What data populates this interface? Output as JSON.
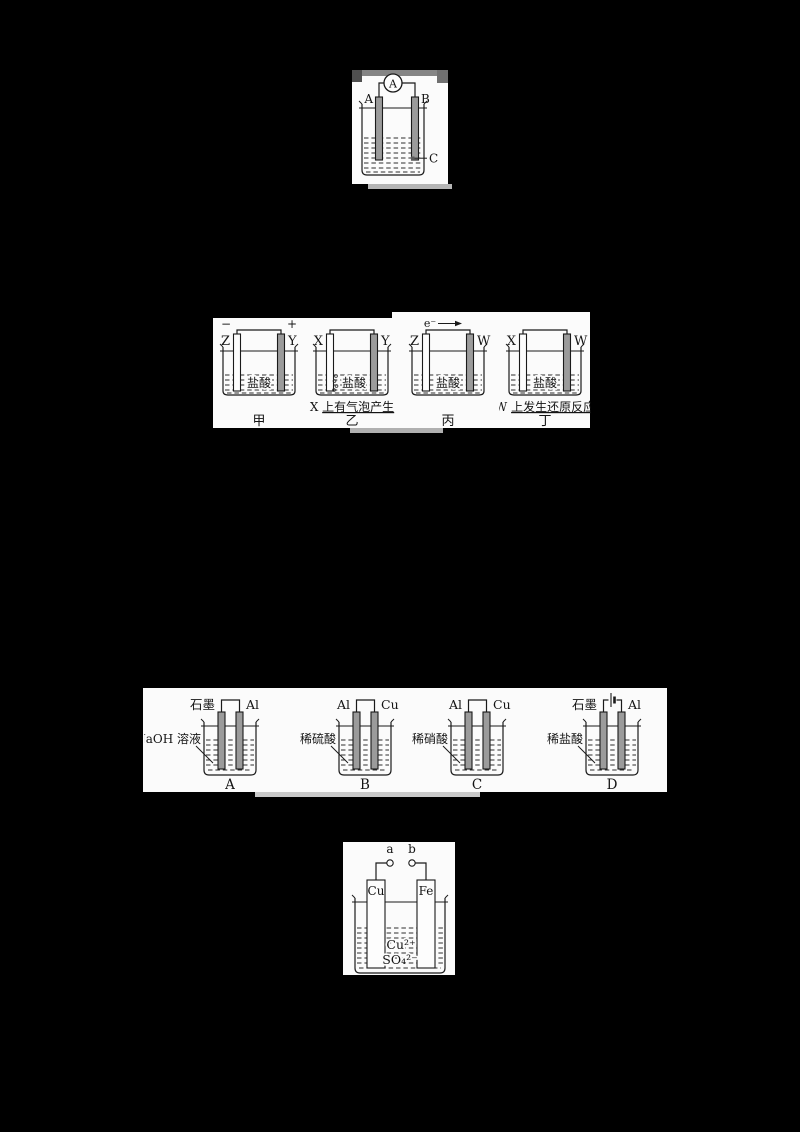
{
  "colors": {
    "background": "#000000",
    "panel": "#fbfbfb",
    "ink": "#1a1a1a",
    "electrode_gray": "#9b9b9b",
    "scan_artifact_gray": "#b5b5b5"
  },
  "figure1": {
    "ammeter": "A",
    "left_electrode": "A",
    "right_electrode": "B",
    "pointer_label": "C"
  },
  "figure2": {
    "cells": [
      {
        "minus": "−",
        "plus": "+",
        "left": "Z",
        "right": "Y",
        "solution": "盐酸",
        "caption": "甲"
      },
      {
        "left": "X",
        "right": "Y",
        "solution": "盐酸",
        "note_prefix": "X ",
        "note": "上有气泡产生",
        "caption": "乙"
      },
      {
        "electron_label": "e⁻",
        "left": "Z",
        "right": "W",
        "solution": "盐酸",
        "caption": "丙"
      },
      {
        "left": "X",
        "right": "W",
        "solution": "盐酸",
        "note_prefix": "W ",
        "note": "上发生还原反应",
        "caption": "丁"
      }
    ]
  },
  "figure3": {
    "cells": [
      {
        "left": "石墨",
        "right": "Al",
        "solution": "NaOH 溶液",
        "caption": "A"
      },
      {
        "left": "Al",
        "right": "Cu",
        "solution": "稀硫酸",
        "caption": "B"
      },
      {
        "left": "Al",
        "right": "Cu",
        "solution": "稀硝酸",
        "caption": "C"
      },
      {
        "left": "石墨",
        "right": "Al",
        "solution": "稀盐酸",
        "caption": "D"
      }
    ]
  },
  "figure4": {
    "terminal_a": "a",
    "terminal_b": "b",
    "left_plate": "Cu",
    "right_plate": "Fe",
    "cation": "Cu²⁺",
    "anion": "SO₄²⁻"
  }
}
